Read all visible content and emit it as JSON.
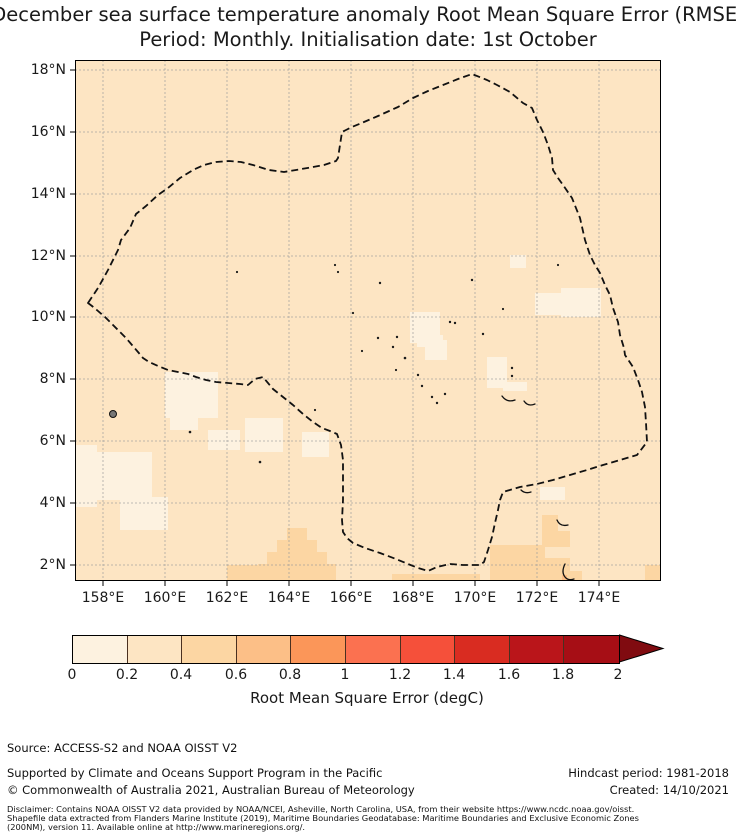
{
  "title": {
    "line1": "December sea surface temperature anomaly Root Mean Square Error (RMSE)",
    "line2": "Period: Monthly. Initialisation date: 1st October"
  },
  "map": {
    "x_ticks": [
      "158°E",
      "160°E",
      "162°E",
      "164°E",
      "166°E",
      "168°E",
      "170°E",
      "172°E",
      "174°E"
    ],
    "y_ticks": [
      "18°N",
      "16°N",
      "14°N",
      "12°N",
      "10°N",
      "8°N",
      "6°N",
      "4°N",
      "2°N"
    ],
    "boundary_name": "exclusive-economic-zone-dashed-boundary"
  },
  "palette": {
    "bin_0_02": "#fdf2e0",
    "bin_02_04": "#fde5c3",
    "bin_04_06": "#fcd6a3",
    "bin_06_08": "#fcbf87",
    "bin_08_10": "#fb9659",
    "bin_10_12": "#fb7150",
    "bin_12_14": "#f5503a",
    "bin_14_16": "#d92c21",
    "bin_16_18": "#ba151a",
    "bin_18_20": "#a60e15",
    "over_2": "#800b10",
    "gridline": "#9b9b9b",
    "boundary": "#111111"
  },
  "colorbar": {
    "tick_labels": [
      "0",
      "0.2",
      "0.4",
      "0.6",
      "0.8",
      "1",
      "1.2",
      "1.4",
      "1.6",
      "1.8",
      "2"
    ],
    "label": "Root Mean Square Error (degC)",
    "segments": [
      "#fdf2e0",
      "#fde5c3",
      "#fcd6a3",
      "#fcbf87",
      "#fb9659",
      "#fb7150",
      "#f5503a",
      "#d92c21",
      "#ba151a",
      "#a60e15"
    ],
    "extend_color": "#800b10"
  },
  "footer": {
    "source": "Source: ACCESS-S2 and NOAA OISST V2",
    "support": "Supported by Climate and Oceans Support Program in the Pacific",
    "copyright": "© Commonwealth of Australia 2021, Australian Bureau of Meteorology",
    "hindcast": "Hindcast period: 1981-2018",
    "created": "Created: 14/10/2021",
    "disclaimer_l1": "Disclaimer: Contains NOAA OISST V2 data provided by NOAA/NCEI, Asheville, North Carolina, USA, from their website https://www.ncdc.noaa.gov/oisst.",
    "disclaimer_l2": "Shapefile data extracted from Flanders Marine Institute (2019), Maritime Boundaries Geodatabase: Maritime Boundaries and Exclusive Economic Zones",
    "disclaimer_l3": "(200NM), version 11. Available online at http://www.marineregions.org/."
  },
  "chart_data": {
    "type": "heatmap",
    "title": "December sea surface temperature anomaly Root Mean Square Error (RMSE)",
    "subtitle": "Period: Monthly. Initialisation date: 1st October",
    "projection": "lon-lat map, Marshall Islands region, western Pacific",
    "lon_range_deg_e": [
      157.1,
      176.0
    ],
    "lat_range_deg_n": [
      1.5,
      18.3
    ],
    "x_tick_values_deg_e": [
      158,
      160,
      162,
      164,
      166,
      168,
      170,
      172,
      174
    ],
    "y_tick_values_deg_n": [
      18,
      16,
      14,
      12,
      10,
      8,
      6,
      4,
      2
    ],
    "grid": true,
    "colorbar": {
      "label": "Root Mean Square Error (degC)",
      "ticks": [
        0,
        0.2,
        0.4,
        0.6,
        0.8,
        1,
        1.2,
        1.4,
        1.6,
        1.8,
        2
      ],
      "extend": "max",
      "bin_width": 0.2
    },
    "field_summary": {
      "background_rmse_degC": "0.2-0.4 over nearly the whole domain",
      "low_rmse_patches_0_to_0.2_lonlat": [
        [
          158.5,
          5.5
        ],
        [
          160.5,
          7.3
        ],
        [
          161.5,
          6.3
        ],
        [
          163.0,
          5.2
        ],
        [
          165.5,
          9.5
        ],
        [
          168.3,
          7.0
        ],
        [
          170.3,
          9.8
        ],
        [
          171.3,
          10.0
        ],
        [
          172.5,
          8.6
        ],
        [
          171.0,
          8.0
        ],
        [
          172.5,
          4.6
        ]
      ],
      "higher_rmse_patches_0.4_to_0.6_lonlat": [
        [
          164.3,
          2.3,
          "stepped pyramid shaped patch near 164°E south of 3.5°N"
        ],
        [
          171.3,
          2.5,
          "large patch 169.5-173°E south of 3.6°N"
        ],
        [
          169.8,
          1.7
        ],
        [
          175.0,
          1.8
        ],
        [
          162.2,
          1.8
        ]
      ],
      "islands": [
        [
          158.3,
          6.9,
          "Pohnpei solid dot"
        ],
        "many tiny atoll specks and reef arcs scattered 162-173°E, 3-12°N (Marshall Islands chains, Gilbert atolls near 172.8°E 2-3.5°N)"
      ]
    },
    "eez_boundary_polygon_lonlat": [
      [
        157.5,
        10.5
      ],
      [
        158.0,
        11.8
      ],
      [
        158.6,
        12.5
      ],
      [
        159.1,
        13.4
      ],
      [
        160.1,
        14.2
      ],
      [
        161.3,
        14.9
      ],
      [
        162.1,
        15.1
      ],
      [
        162.8,
        14.9
      ],
      [
        163.8,
        14.7
      ],
      [
        164.8,
        14.9
      ],
      [
        165.5,
        15.1
      ],
      [
        165.7,
        16.0
      ],
      [
        166.9,
        16.5
      ],
      [
        168.5,
        17.3
      ],
      [
        169.9,
        17.9
      ],
      [
        171.1,
        17.3
      ],
      [
        171.8,
        16.8
      ],
      [
        172.2,
        16.0
      ],
      [
        172.5,
        14.8
      ],
      [
        173.1,
        13.9
      ],
      [
        173.5,
        12.5
      ],
      [
        174.0,
        11.5
      ],
      [
        174.5,
        10.3
      ],
      [
        174.8,
        8.8
      ],
      [
        175.3,
        8.0
      ],
      [
        175.5,
        6.0
      ],
      [
        175.2,
        5.6
      ],
      [
        174.1,
        5.2
      ],
      [
        173.1,
        4.9
      ],
      [
        172.0,
        4.6
      ],
      [
        170.9,
        4.4
      ],
      [
        170.6,
        3.4
      ],
      [
        170.4,
        2.5
      ],
      [
        170.2,
        2.0
      ],
      [
        169.2,
        2.0
      ],
      [
        168.5,
        1.8
      ],
      [
        167.8,
        2.0
      ],
      [
        166.9,
        2.4
      ],
      [
        166.1,
        2.7
      ],
      [
        165.7,
        3.1
      ],
      [
        165.7,
        5.4
      ],
      [
        165.5,
        6.2
      ],
      [
        164.8,
        6.6
      ],
      [
        163.8,
        7.4
      ],
      [
        163.2,
        8.1
      ],
      [
        162.7,
        7.8
      ],
      [
        161.7,
        7.9
      ],
      [
        160.7,
        8.2
      ],
      [
        159.8,
        8.4
      ],
      [
        159.1,
        8.9
      ],
      [
        158.5,
        9.6
      ],
      [
        157.9,
        10.2
      ]
    ]
  }
}
